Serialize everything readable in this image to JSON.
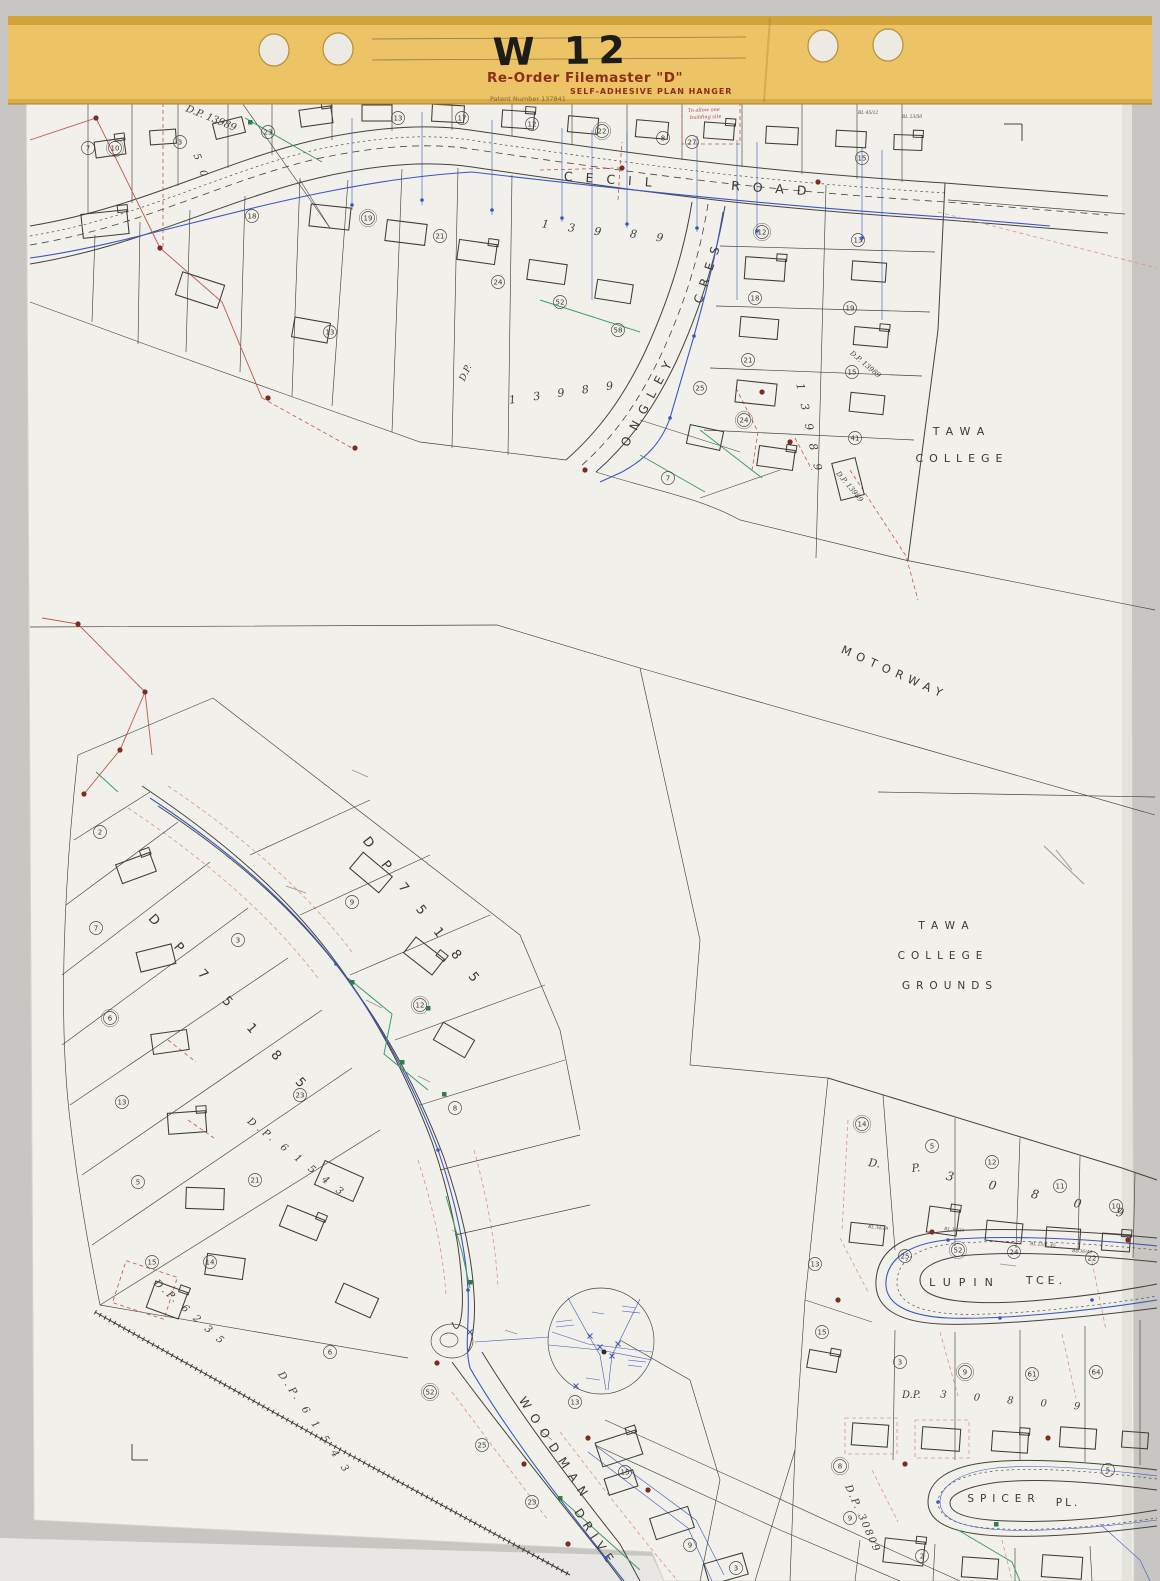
{
  "header": {
    "code": "W 12",
    "product": "Re-Order Filemaster \"D\"",
    "subtitle": "SELF-ADHESIVE PLAN HANGER",
    "patent": "Patent Number 137841"
  },
  "map": {
    "streets": {
      "cecil": "CECIL",
      "road": "ROAD",
      "ongley": "ONGLEY",
      "cres": "CRES",
      "motorway": "MOTORWAY",
      "woodman": "WOODMAN",
      "drive": "DRIVE",
      "lupin": "LUPIN",
      "tce": "TCE.",
      "spicer": "SPICER",
      "pl": "PL."
    },
    "areas": {
      "tawa_a": "TAWA",
      "college_a": "COLLEGE",
      "tawa_b": "TAWA",
      "college_b": "COLLEGE",
      "grounds_b": "GROUNDS"
    },
    "plan_numbers": {
      "dp13989_nw": "D.P. 13989",
      "lot_139": "1 3 9",
      "lot_89": "8 9",
      "dp_abbrev": "D.P.",
      "lot_13989_arc": "1 3 9 8 9",
      "lot_13989_v": "1 3 9 8 9",
      "dp13989_sm1": "D.P. 13989",
      "dp13989_sm2": "D.P. 13989",
      "lot_50": "5 0",
      "dp75185_road": "D P 7 5 1 8 5",
      "dp75185_west": "D P 7 5 1 8 5",
      "dp61543_upper": "D.P. 6 1 5 4 3",
      "dp6235": "D.P. 6 2 3 5",
      "dp61543_lower": "D.P. 6 1 5 4 3",
      "dp30809_d": "D.",
      "dp30809_p": "P.",
      "dp30809_digits": "3 0 8 0 9",
      "dp30809_mid_dp": "D.P.",
      "dp30809_mid_digits": "3 0 8 0 9",
      "dp30809_diag": "D.P. 30809"
    },
    "notes": {
      "building_site_1": "To allow one",
      "building_site_2": "building site"
    },
    "house_refs": [
      "BL 45/12",
      "BL 23/50",
      "BL 34/29",
      "BL 36/29",
      "BL 25/4, 45",
      "BL 36/40"
    ],
    "circles": [
      "10",
      "3",
      "23",
      "13",
      "17",
      "12",
      "22",
      "8",
      "27",
      "15",
      "7",
      "18",
      "19",
      "21",
      "13",
      "24",
      "52",
      "58",
      "12",
      "13",
      "18",
      "19",
      "21",
      "15",
      "24",
      "41",
      "25",
      "7",
      "2",
      "7",
      "6",
      "13",
      "5",
      "15",
      "3",
      "9",
      "12",
      "8",
      "23",
      "21",
      "14",
      "6",
      "52",
      "25",
      "23",
      "15",
      "9",
      "13",
      "14",
      "5",
      "12",
      "11",
      "10",
      "25",
      "52",
      "24",
      "22",
      "13",
      "15",
      "3",
      "9",
      "61",
      "64",
      "9",
      "2",
      "5",
      "8",
      "3"
    ]
  }
}
